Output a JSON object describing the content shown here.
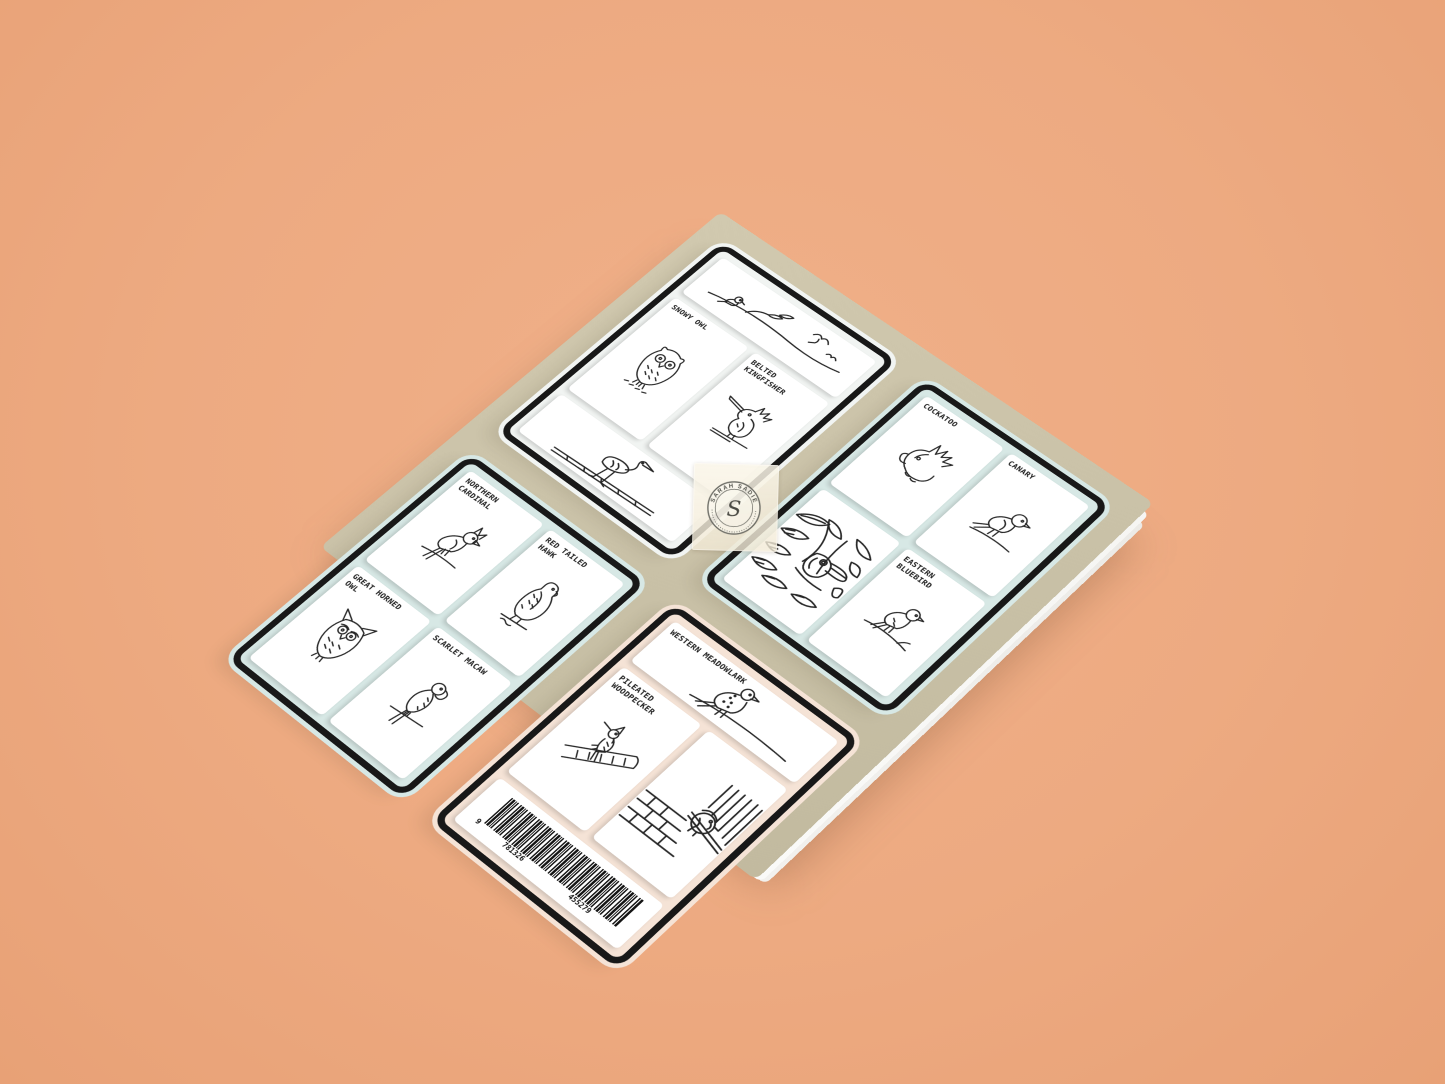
{
  "colors": {
    "background": "#edaa81",
    "cover": "#c9c1a7",
    "ink": "#181818",
    "panel_white": "#f1f4f2",
    "panel_blue": "#d7e8e5",
    "panel_peach": "#f5e3d6",
    "card": "#ffffff",
    "tape": "#f4eedd",
    "page_edge": "#ededeb"
  },
  "seal": {
    "brand": "SARAH SADIE",
    "initial": "S"
  },
  "barcode": {
    "lead_digit": "9",
    "group1": "781326",
    "group2": "455279"
  },
  "panels": [
    {
      "name": "top",
      "bg": "#f1f4f2",
      "cards": [
        {
          "art": "perched-birds-on-branch"
        },
        {
          "label": "SNOWY OWL",
          "art": "snowy-owl"
        },
        {
          "label": "BELTED KINGFISHER",
          "art": "belted-kingfisher"
        },
        {
          "art": "heron-on-log"
        }
      ]
    },
    {
      "name": "right",
      "bg": "#d7e8e5",
      "cards": [
        {
          "label": "COCKATOO",
          "art": "cockatoo"
        },
        {
          "label": "CANARY",
          "art": "canary"
        },
        {
          "art": "toucan-in-foliage"
        },
        {
          "label": "EASTERN BLUEBIRD",
          "art": "eastern-bluebird"
        }
      ]
    },
    {
      "name": "left",
      "bg": "#d7e8e5",
      "cards": [
        {
          "label": "NORTHERN CARDINAL",
          "art": "northern-cardinal"
        },
        {
          "label": "RED TAILED HAWK",
          "art": "red-tailed-hawk"
        },
        {
          "label": "GREAT HORNED OWL",
          "art": "great-horned-owl"
        },
        {
          "label": "SCARLET MACAW",
          "art": "scarlet-macaw"
        }
      ]
    },
    {
      "name": "bottom",
      "bg": "#f5e3d6",
      "cards": [
        {
          "label": "WESTERN MEADOWLARK",
          "art": "western-meadowlark"
        },
        {
          "label": "PILEATED WOODPECKER",
          "art": "pileated-woodpecker"
        },
        {
          "art": "chickadee-at-window"
        },
        {
          "art": "barcode"
        }
      ]
    }
  ]
}
